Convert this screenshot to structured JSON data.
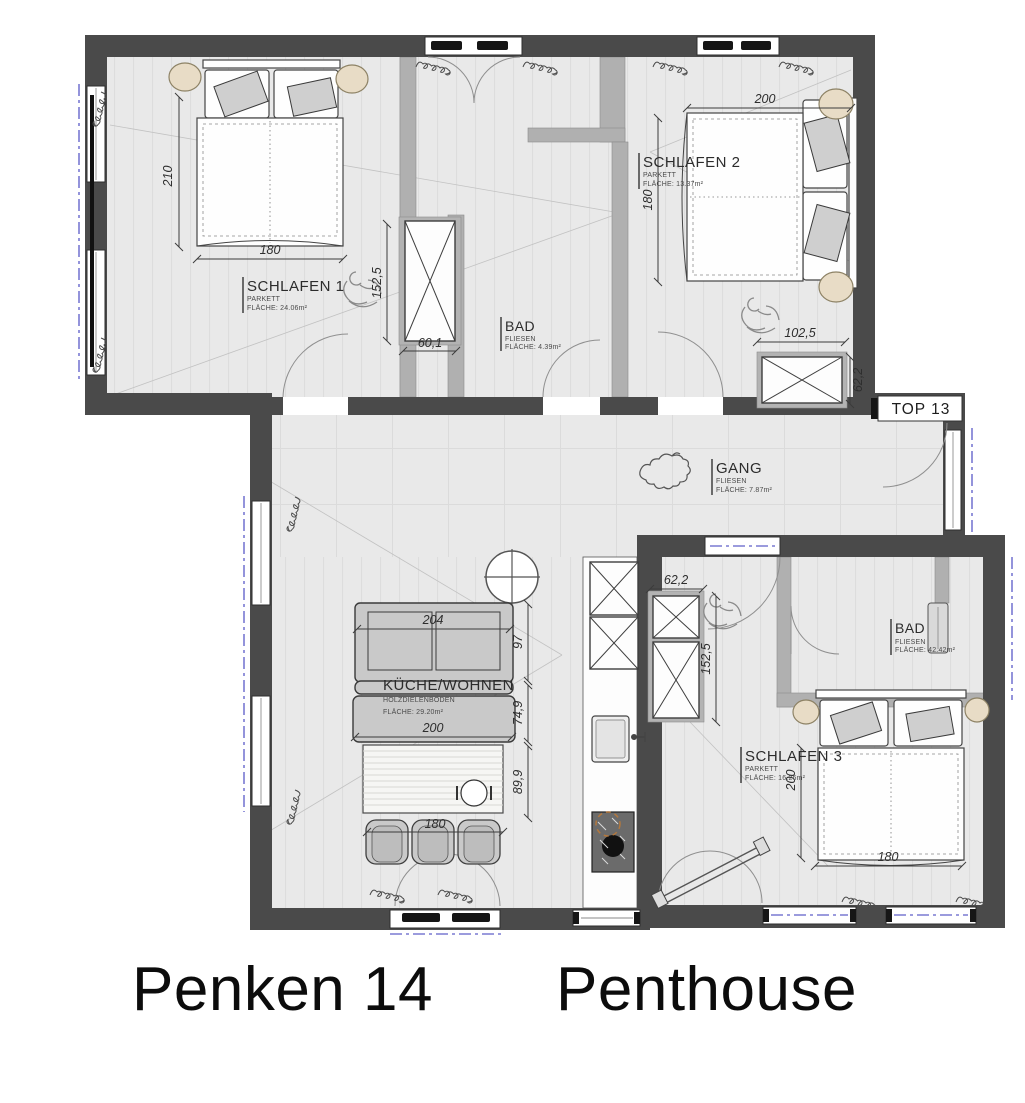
{
  "title": {
    "project": "Penken 14",
    "unit": "Penthouse"
  },
  "unit_badge": "TOP 13",
  "rooms": {
    "schlafen1": {
      "name": "SCHLAFEN 1",
      "floor": "PARKETT",
      "area": "FLÄCHE: 24.06m²"
    },
    "schlafen2": {
      "name": "SCHLAFEN 2",
      "floor": "PARKETT",
      "area": "FLÄCHE: 13.37m²"
    },
    "bad1": {
      "name": "BAD",
      "floor": "FLIESEN",
      "area": "FLÄCHE: 4.39m²"
    },
    "gang": {
      "name": "GANG",
      "floor": "FLIESEN",
      "area": "FLÄCHE: 7.87m²"
    },
    "kueche": {
      "name": "KÜCHE/WOHNEN",
      "floor": "HOLZDIELENBODEN",
      "area": "FLÄCHE: 29.20m²"
    },
    "schlafen3": {
      "name": "SCHLAFEN 3",
      "floor": "PARKETT",
      "area": "FLÄCHE: 16.26m²"
    },
    "bad2": {
      "name": "BAD",
      "floor": "FLIESEN",
      "area": "FLÄCHE: 42.42m²"
    }
  },
  "dimensions": {
    "s1_bed_h": "210",
    "s1_bed_w": "180",
    "s1_wardrobe_w": "60,1",
    "s1_wardrobe_h": "152,5",
    "s2_bed_w": "200",
    "s2_bed_h": "180",
    "s2_dresser_w": "102,5",
    "s2_dresser_h": "62,2",
    "shaft_w": "62,2",
    "shaft_h": "152,5",
    "sofa_w": "204",
    "sofa_d": "97",
    "bench_w": "200",
    "bench_d": "74,9",
    "table_d": "89,9",
    "table_w": "180",
    "s3_bed_h": "200",
    "s3_bed_w": "180"
  },
  "colors": {
    "outer_wall": "#4a4a4a",
    "interior_wall": "#b0b0b0",
    "floor": "#e9e9e9",
    "roof_slope_blue": "#7a7ad2",
    "furniture_gray": "#c9c9c9",
    "lamp_beige": "#e8dcc6"
  }
}
